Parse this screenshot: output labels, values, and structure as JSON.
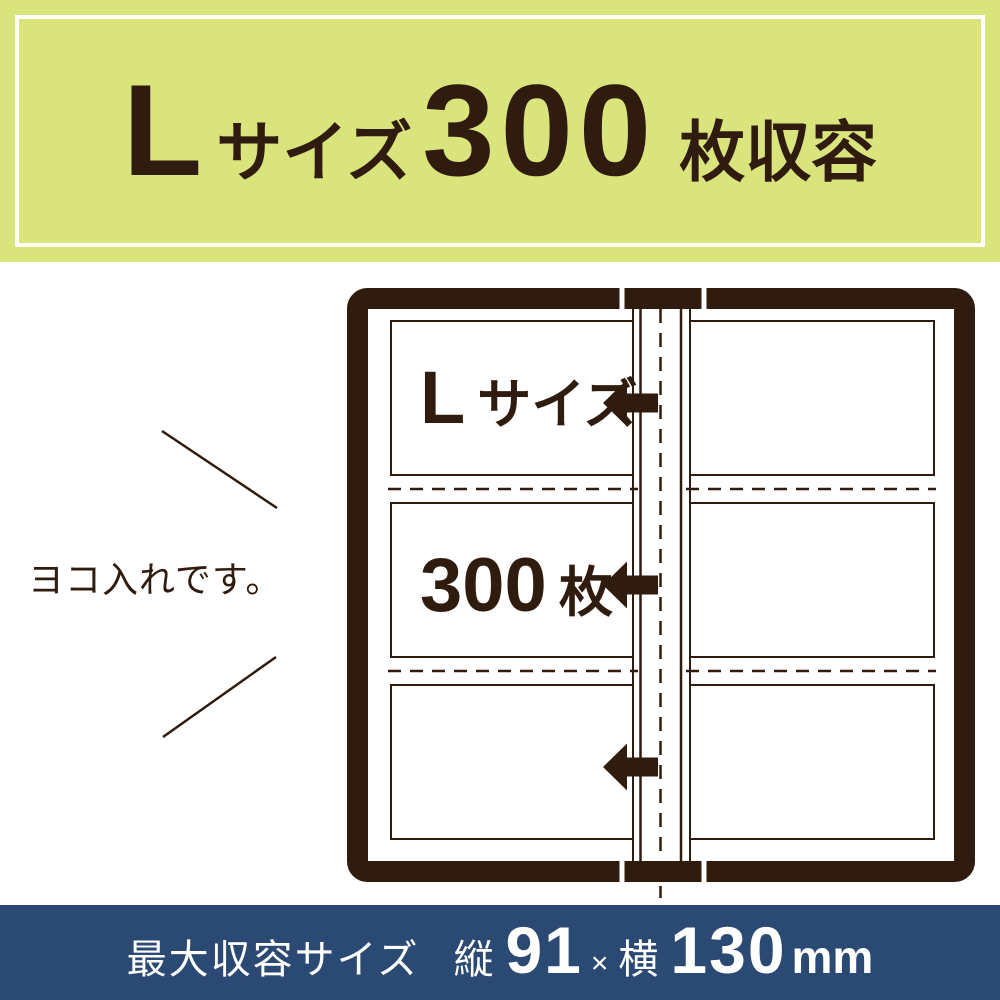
{
  "top_banner": {
    "size_letter": "L",
    "size_label": "サイズ",
    "count": "300",
    "count_suffix": "枚収容",
    "bg_color": "#d9e47c",
    "text_color": "#301c0e"
  },
  "album_diagram": {
    "row1_label_letter": "L",
    "row1_label": "サイズ",
    "row2_count": "300",
    "row2_unit": "枚",
    "orientation_note": "ヨコ入れです。",
    "frame_color": "#301c0e",
    "slots_per_page": 3,
    "pages_shown": 2
  },
  "bottom_banner": {
    "label": "最大収容サイズ",
    "height_label": "縦",
    "height_value": "91",
    "multiply": "×",
    "width_label": "横",
    "width_value": "130",
    "unit": "mm",
    "bg_color": "#2b4a73",
    "text_color": "#ffffff"
  }
}
